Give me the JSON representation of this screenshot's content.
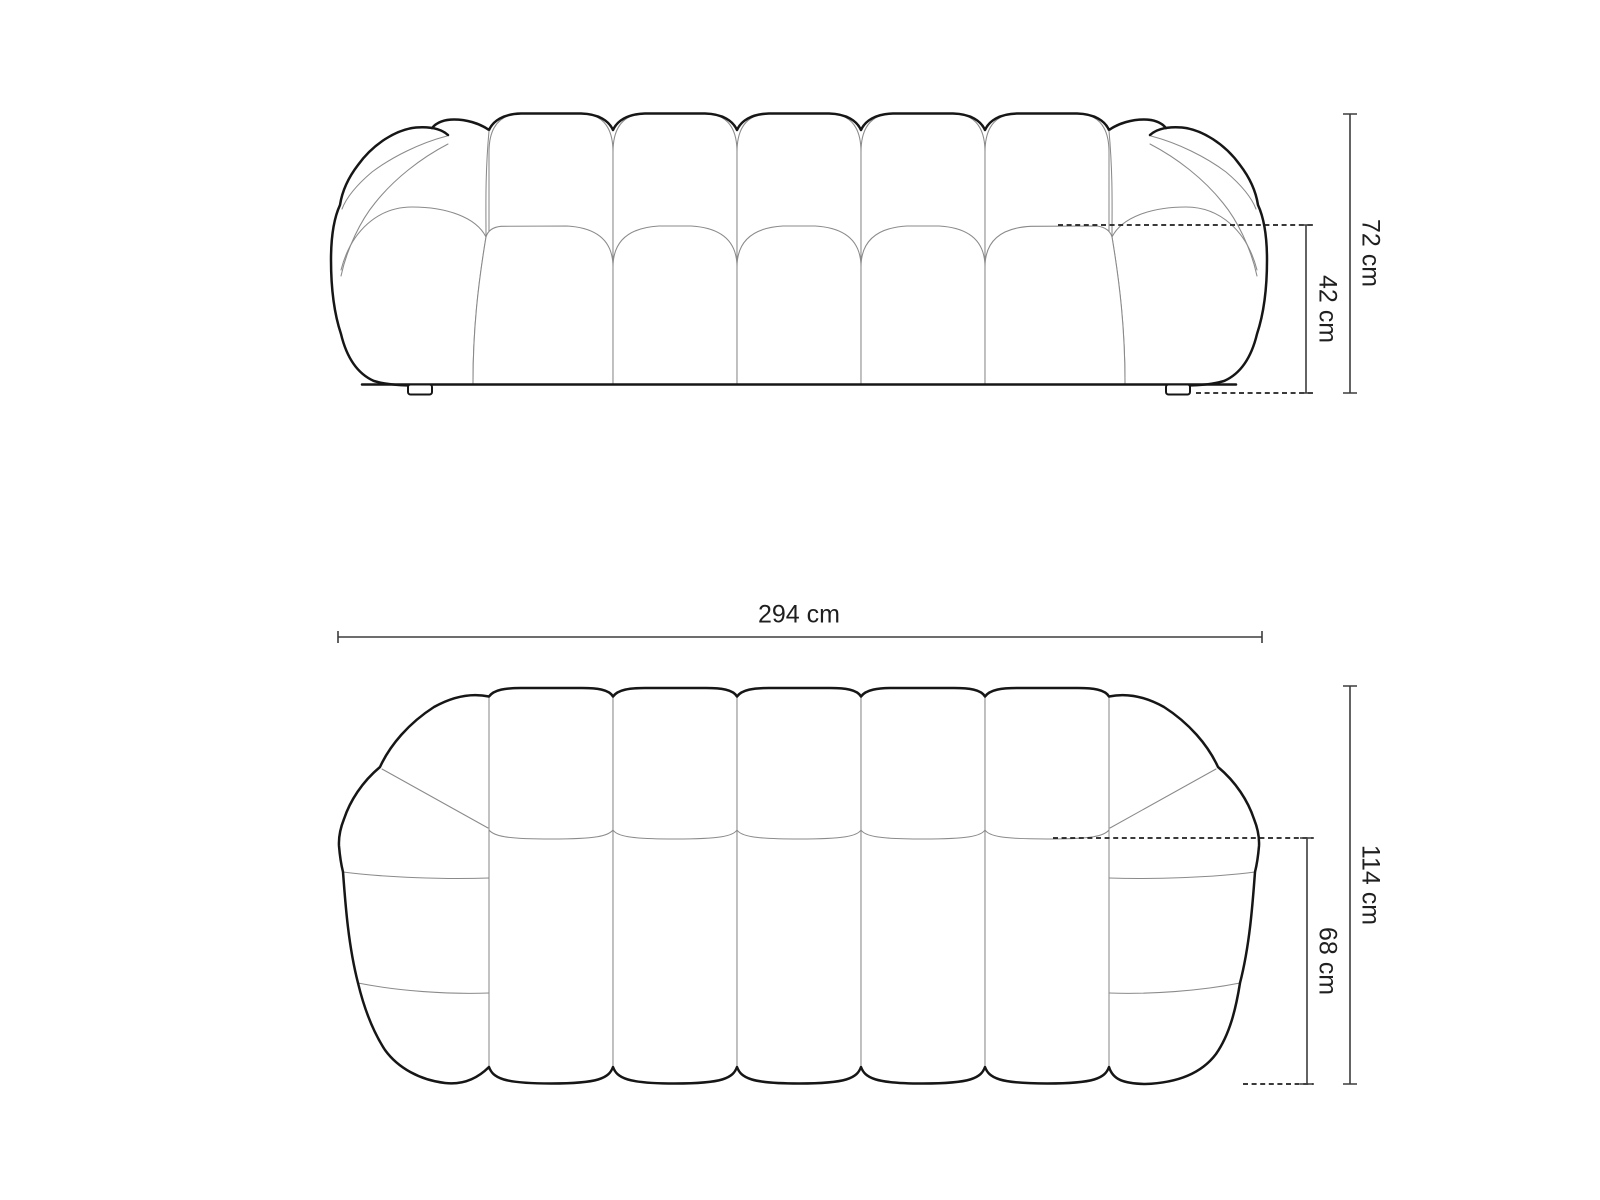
{
  "page": {
    "title": "Sofa dimension diagram"
  },
  "views": {
    "front_elevation": {
      "labels": {
        "total_height": "72 cm",
        "seat_height": "42 cm"
      }
    },
    "top_plan": {
      "labels": {
        "total_width": "294 cm",
        "total_depth": "114 cm",
        "seat_depth": "68 cm"
      }
    }
  },
  "colors": {
    "background": "#ffffff",
    "outline_bold": "#161616",
    "outline_thin": "#8a8a8a",
    "dimension_line": "#3d3d3d",
    "dashed_line": "#1e1e1e",
    "label_text": "#1f1f1f"
  }
}
